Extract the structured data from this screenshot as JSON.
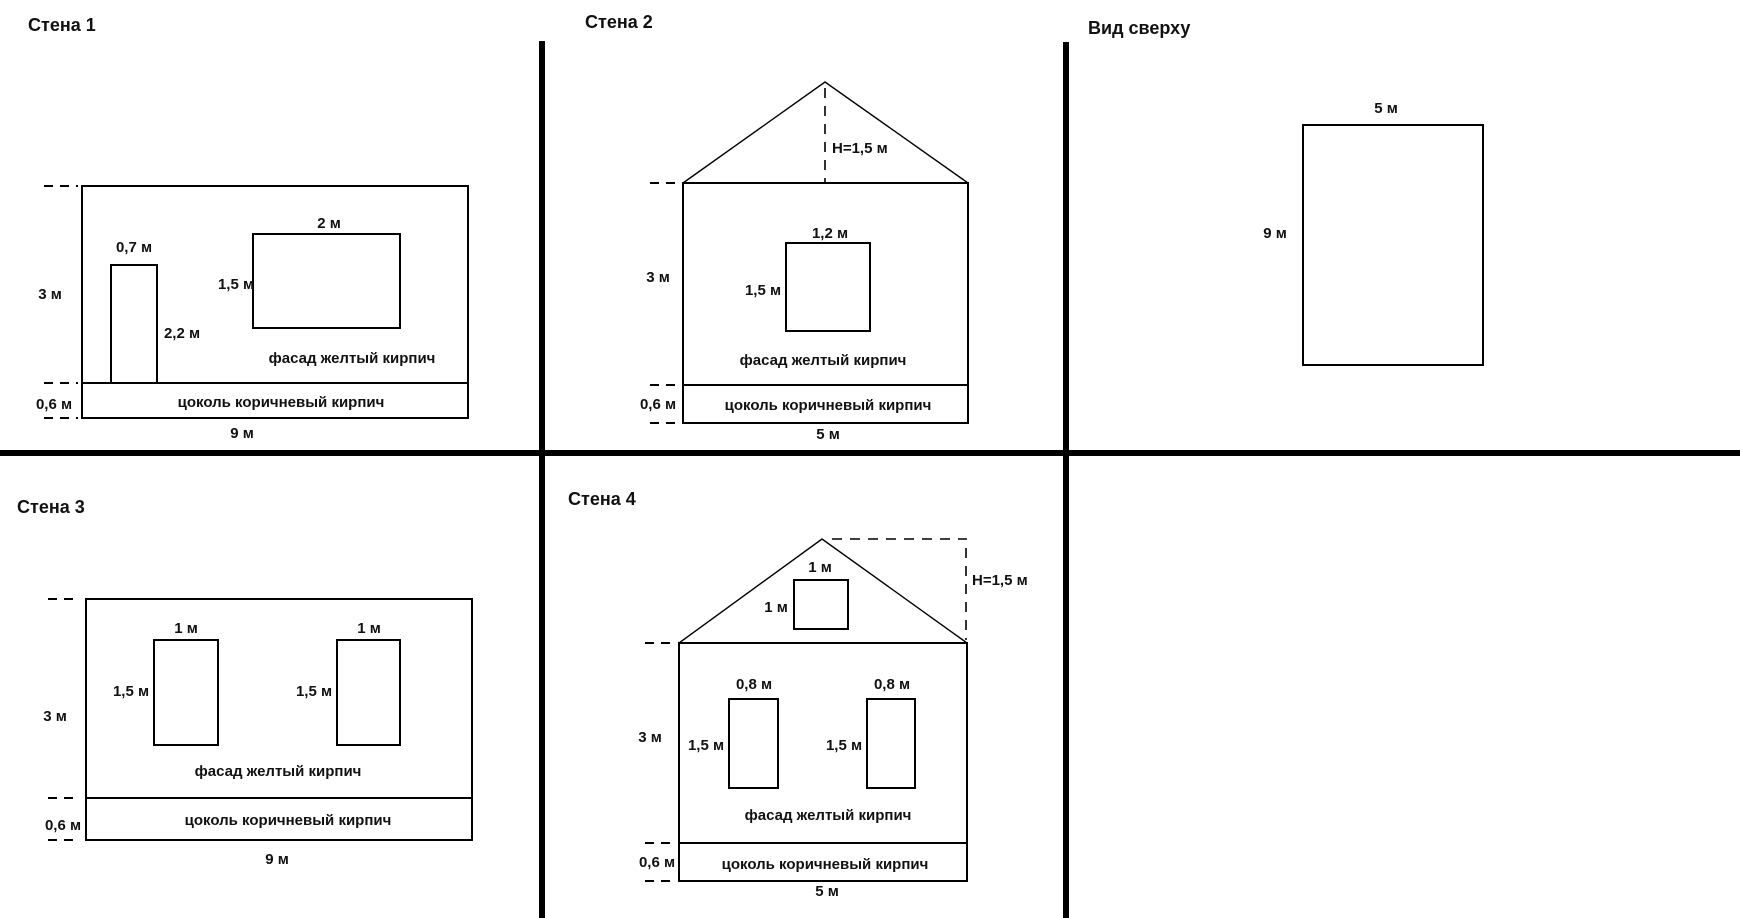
{
  "colors": {
    "line": "#000000",
    "background": "#ffffff",
    "text": "#111111"
  },
  "panels": {
    "wall1": {
      "title": "Стена 1",
      "wall_height": "3 м",
      "wall_width": "9 м",
      "plinth_height": "0,6 м",
      "door_width": "0,7 м",
      "door_height": "2,2 м",
      "window_width": "2 м",
      "window_height": "1,5 м",
      "facade_label": "фасад желтый кирпич",
      "plinth_label": "цоколь коричневый кирпич"
    },
    "wall2": {
      "title": "Стена 2",
      "roof_height": "H=1,5 м",
      "wall_height": "3 м",
      "wall_width": "5 м",
      "plinth_height": "0,6 м",
      "window_width": "1,2 м",
      "window_height": "1,5 м",
      "facade_label": "фасад желтый кирпич",
      "plinth_label": "цоколь коричневый кирпич"
    },
    "top_view": {
      "title": "Вид сверху",
      "width": "5 м",
      "depth": "9 м"
    },
    "wall3": {
      "title": "Стена 3",
      "wall_height": "3 м",
      "wall_width": "9 м",
      "plinth_height": "0,6 м",
      "window_width": "1 м",
      "window_height": "1,5 м",
      "facade_label": "фасад желтый кирпич",
      "plinth_label": "цоколь коричневый кирпич"
    },
    "wall4": {
      "title": "Стена 4",
      "roof_height": "H=1,5 м",
      "attic_window_width": "1 м",
      "attic_window_height": "1 м",
      "wall_height": "3 м",
      "wall_width": "5 м",
      "plinth_height": "0,6 м",
      "window_width": "0,8 м",
      "window_height": "1,5 м",
      "facade_label": "фасад желтый кирпич",
      "plinth_label": "цоколь коричневый кирпич"
    }
  }
}
